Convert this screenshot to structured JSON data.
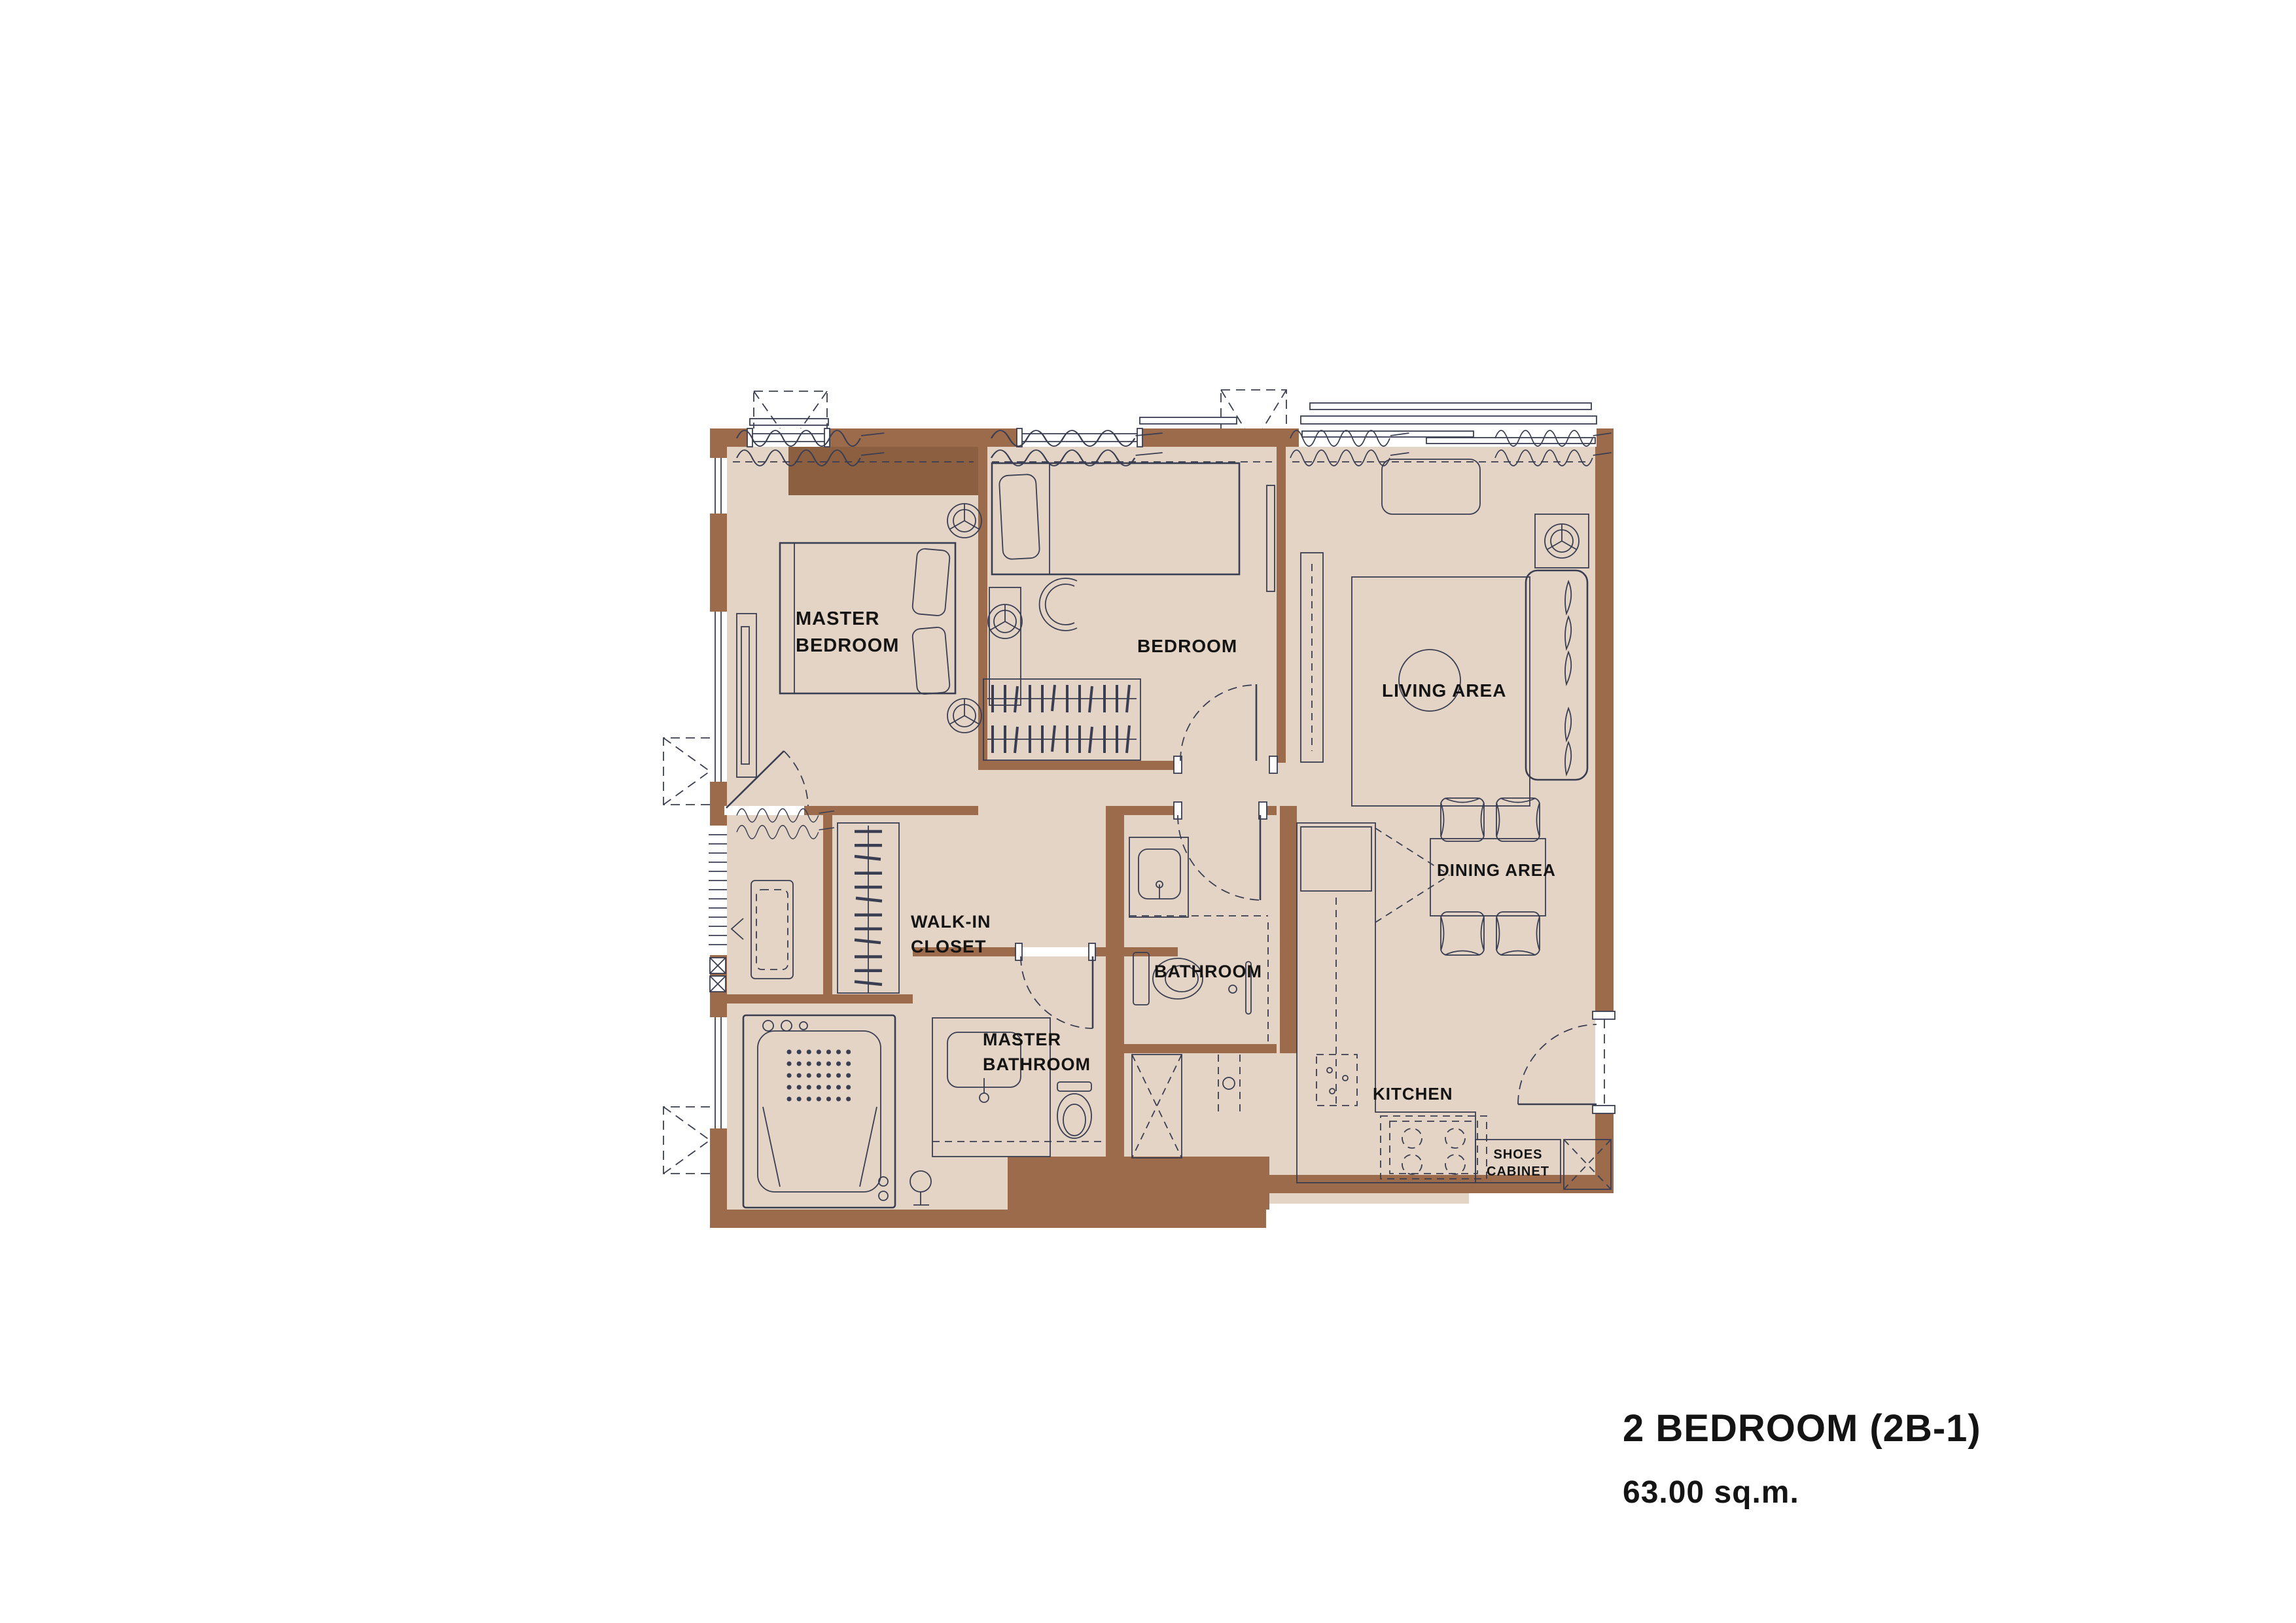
{
  "title": {
    "line1": "2 BEDROOM (2B-1)",
    "line2": "63.00 sq.m."
  },
  "rooms": {
    "master_bedroom": {
      "label": "MASTER\nBEDROOM"
    },
    "bedroom": {
      "label": "BEDROOM"
    },
    "living_area": {
      "label": "LIVING AREA"
    },
    "dining_area": {
      "label": "DINING AREA"
    },
    "walk_in_closet": {
      "label": "WALK-IN\nCLOSET"
    },
    "bathroom": {
      "label": "BATHROOM"
    },
    "master_bathroom": {
      "label": "MASTER\nBATHROOM"
    },
    "kitchen": {
      "label": "KITCHEN"
    },
    "shoes_cabinet": {
      "label": "SHOES\nCABINET"
    }
  },
  "colors": {
    "floor": "#e3d4c5",
    "wall": "#9b6b4b",
    "wall_dark": "#8c5f41",
    "line": "#3a3e52",
    "text": "#141414",
    "background": "#ffffff"
  }
}
